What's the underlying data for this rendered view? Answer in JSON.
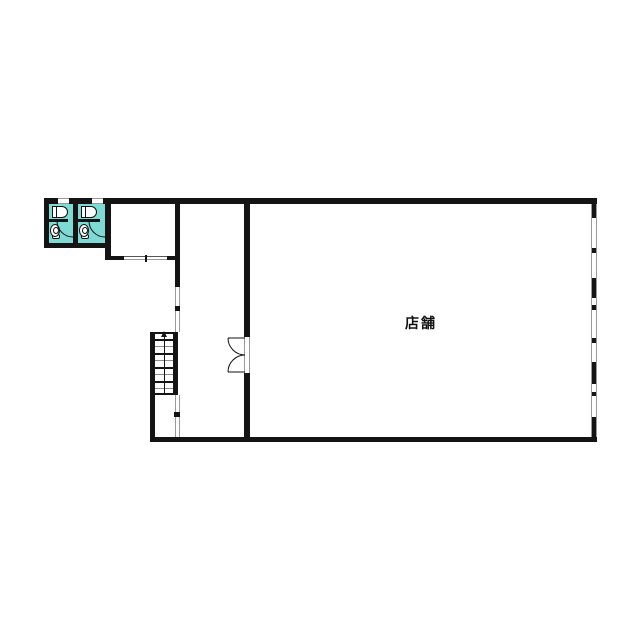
{
  "plan": {
    "shop": {
      "label": "店舗"
    },
    "colors": {
      "wall": "#141414",
      "toilet_fill": "#7edad5",
      "window_line": "#999999",
      "opening_line": "#b3b3b3",
      "fixture_outline": "#111111",
      "background": "#ffffff"
    }
  }
}
